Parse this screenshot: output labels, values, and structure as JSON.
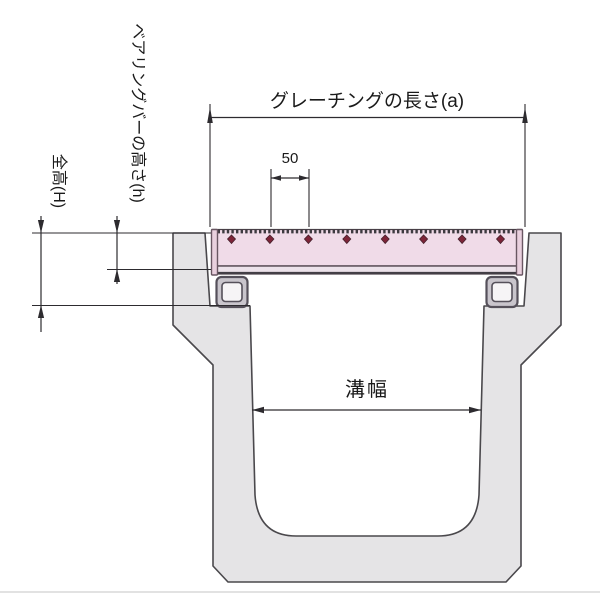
{
  "drawing": {
    "labels": {
      "bearing_bar_height": "ベアリングバーの高さ(h)",
      "total_height": "全高(H)",
      "grating_length": "グレーチングの長さ(a)",
      "crossbar_pitch": "50",
      "groove_width": "溝幅"
    },
    "colors": {
      "background": "#ffffff",
      "concrete_fill": "#e5e4e6",
      "grating_fill": "#f0dbe8",
      "grating_bottom_strip": "#ece2ea",
      "end_plate_fill": "#e9d0de",
      "crossbar_marker": "#7d2438",
      "tube_wall_fill": "#c9c5cc",
      "tube_inner_fill": "#f6f4f6",
      "outline": "#4a484c",
      "dimension_line": "#2d2b2f"
    }
  }
}
